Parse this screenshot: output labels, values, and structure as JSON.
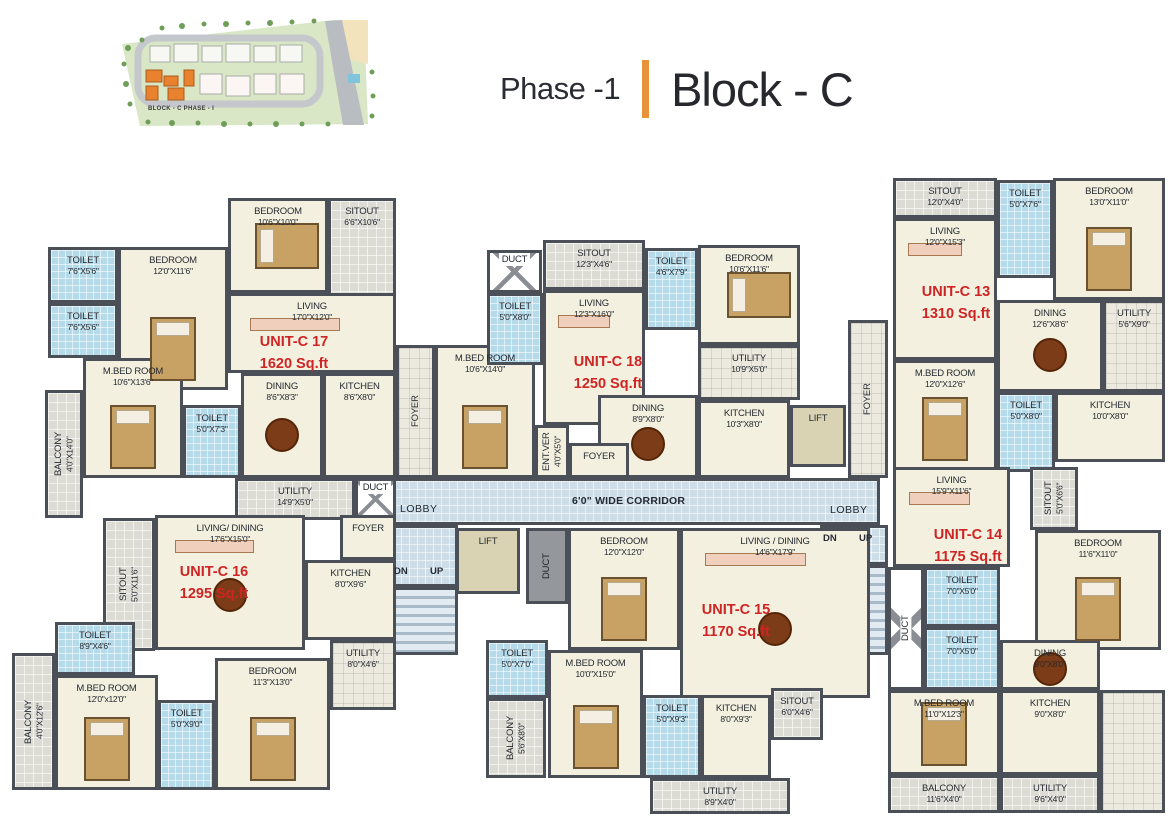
{
  "header": {
    "phase": "Phase -1",
    "block": "Block - C"
  },
  "site_map": {
    "label": "BLOCK - C  PHASE - I"
  },
  "palette": {
    "accent_orange": "#e8923a",
    "wall": "#4b4f58",
    "unit_label_red": "#cf2424",
    "floor_cream": "#f3f0df",
    "toilet_tile_blue": "#b5dbeb",
    "corridor_blue": "#cddee9",
    "sitout_gray": "#dddcd4",
    "lift_olive": "#d9d3b4",
    "site_block_highlight": "#e8822f"
  },
  "plan": {
    "rooms": [
      {
        "u": "common",
        "k": "corridor",
        "n": "",
        "x": 390,
        "y": 478,
        "w": 490,
        "h": 47,
        "f": "corridor"
      },
      {
        "u": "common",
        "k": "lobby-left",
        "n": "",
        "x": 390,
        "y": 525,
        "w": 68,
        "h": 62,
        "f": "corridor"
      },
      {
        "u": "common",
        "k": "lobby-right",
        "n": "",
        "x": 820,
        "y": 525,
        "w": 68,
        "h": 40,
        "f": "corridor"
      },
      {
        "u": "common",
        "k": "stairs-left",
        "n": "",
        "x": 390,
        "y": 587,
        "w": 68,
        "h": 68,
        "f": "stairs"
      },
      {
        "u": "common",
        "k": "stairs-right",
        "n": "",
        "x": 820,
        "y": 565,
        "w": 68,
        "h": 90,
        "f": "stairs"
      },
      {
        "u": "common",
        "n": "FOYER",
        "x": 396,
        "y": 345,
        "w": 39,
        "h": 133,
        "f": "grayx",
        "v": 1
      },
      {
        "u": "common",
        "n": "FOYER",
        "x": 848,
        "y": 320,
        "w": 40,
        "h": 158,
        "f": "grayx",
        "v": 1
      },
      {
        "u": "common",
        "n": "LIFT",
        "x": 790,
        "y": 405,
        "w": 56,
        "h": 62,
        "f": "lift"
      },
      {
        "u": "common",
        "n": "LIFT",
        "x": 456,
        "y": 528,
        "w": 64,
        "h": 66,
        "f": "lift"
      },
      {
        "u": "common",
        "n": "DUCT",
        "x": 526,
        "y": 528,
        "w": 42,
        "h": 76,
        "f": "duct",
        "v": 1
      },
      {
        "u": "17",
        "n": "TOILET",
        "d": "7'6\"X5'6\"",
        "x": 48,
        "y": 247,
        "w": 70,
        "h": 56,
        "f": "tile"
      },
      {
        "u": "17",
        "n": "TOILET",
        "d": "7'6\"X5'6\"",
        "x": 48,
        "y": 303,
        "w": 70,
        "h": 55,
        "f": "tile"
      },
      {
        "u": "17",
        "n": "BEDROOM",
        "d": "12'0\"X11'6\"",
        "x": 118,
        "y": 247,
        "w": 110,
        "h": 143,
        "f": "floor",
        "furn": "bedv"
      },
      {
        "u": "17",
        "n": "BEDROOM",
        "d": "10'6\"X10'0\"",
        "x": 228,
        "y": 198,
        "w": 100,
        "h": 95,
        "f": "floor",
        "furn": "bedh"
      },
      {
        "u": "17",
        "n": "SITOUT",
        "d": "6'6\"X10'6\"",
        "x": 328,
        "y": 198,
        "w": 68,
        "h": 105,
        "f": "gray"
      },
      {
        "u": "17",
        "n": "LIVING",
        "d": "17'0\"X12'0\"",
        "x": 228,
        "y": 293,
        "w": 168,
        "h": 80,
        "f": "floor",
        "furn": "sofa"
      },
      {
        "u": "17",
        "n": "M.BED ROOM",
        "d": "10'6\"X13'6\"",
        "x": 83,
        "y": 358,
        "w": 100,
        "h": 120,
        "f": "floor",
        "furn": "bedv"
      },
      {
        "u": "17",
        "n": "BALCONY",
        "d": "4'0\"X14'0\"",
        "x": 45,
        "y": 390,
        "w": 38,
        "h": 128,
        "f": "gray",
        "v": 1
      },
      {
        "u": "17",
        "n": "TOILET",
        "d": "5'0\"X7'3\"",
        "x": 183,
        "y": 405,
        "w": 58,
        "h": 73,
        "f": "tile"
      },
      {
        "u": "17",
        "n": "DINING",
        "d": "8'6\"X8'3\"",
        "x": 241,
        "y": 373,
        "w": 82,
        "h": 105,
        "f": "floor",
        "furn": "table"
      },
      {
        "u": "17",
        "n": "KITCHEN",
        "d": "8'6\"X8'0\"",
        "x": 323,
        "y": 373,
        "w": 73,
        "h": 105,
        "f": "floor"
      },
      {
        "u": "17",
        "n": "UTILITY",
        "d": "14'9\"X5'0\"",
        "x": 235,
        "y": 478,
        "w": 120,
        "h": 42,
        "f": "gray"
      },
      {
        "u": "17",
        "n": "DUCT",
        "d": "",
        "x": 355,
        "y": 478,
        "w": 41,
        "h": 42,
        "f": "ductx"
      },
      {
        "u": "18",
        "n": "M.BED ROOM",
        "d": "10'6\"X14'0\"",
        "x": 435,
        "y": 345,
        "w": 100,
        "h": 133,
        "f": "floor",
        "furn": "bedv"
      },
      {
        "u": "18",
        "n": "DUCT",
        "d": "",
        "x": 487,
        "y": 250,
        "w": 55,
        "h": 43,
        "f": "ductx"
      },
      {
        "u": "18",
        "n": "TOILET",
        "d": "5'0\"X8'0\"",
        "x": 487,
        "y": 293,
        "w": 56,
        "h": 72,
        "f": "tile"
      },
      {
        "u": "18",
        "n": "SITOUT",
        "d": "12'3\"X4'6\"",
        "x": 543,
        "y": 240,
        "w": 102,
        "h": 50,
        "f": "gray"
      },
      {
        "u": "18",
        "n": "TOILET",
        "d": "4'6\"X7'9\"",
        "x": 645,
        "y": 248,
        "w": 53,
        "h": 82,
        "f": "tile"
      },
      {
        "u": "18",
        "n": "BEDROOM",
        "d": "10'6\"X11'6\"",
        "x": 698,
        "y": 245,
        "w": 102,
        "h": 100,
        "f": "floor",
        "furn": "bedh"
      },
      {
        "u": "18",
        "n": "LIVING",
        "d": "12'3\"X16'0\"",
        "x": 543,
        "y": 290,
        "w": 102,
        "h": 135,
        "f": "floor",
        "furn": "sofa"
      },
      {
        "u": "18",
        "n": "UTILITY",
        "d": "10'9\"X5'0\"",
        "x": 698,
        "y": 345,
        "w": 102,
        "h": 55,
        "f": "grayx"
      },
      {
        "u": "18",
        "n": "DINING",
        "d": "8'9\"X8'0\"",
        "x": 598,
        "y": 395,
        "w": 100,
        "h": 83,
        "f": "floor",
        "furn": "table"
      },
      {
        "u": "18",
        "n": "KITCHEN",
        "d": "10'3\"X8'0\"",
        "x": 698,
        "y": 400,
        "w": 92,
        "h": 78,
        "f": "floor"
      },
      {
        "u": "18",
        "n": "ENT.VER",
        "d": "4'0\"X5'0\"",
        "x": 535,
        "y": 425,
        "w": 34,
        "h": 53,
        "f": "floor",
        "v": 1
      },
      {
        "u": "18",
        "n": "FOYER",
        "d": "",
        "x": 569,
        "y": 443,
        "w": 60,
        "h": 35,
        "f": "floor"
      },
      {
        "u": "13",
        "n": "SITOUT",
        "d": "12'0\"X4'0\"",
        "x": 893,
        "y": 178,
        "w": 104,
        "h": 40,
        "f": "gray"
      },
      {
        "u": "13",
        "n": "TOILET",
        "d": "5'0\"X7'6\"",
        "x": 997,
        "y": 180,
        "w": 56,
        "h": 98,
        "f": "tile"
      },
      {
        "u": "13",
        "n": "BEDROOM",
        "d": "13'0\"X11'0\"",
        "x": 1053,
        "y": 178,
        "w": 112,
        "h": 122,
        "f": "floor",
        "furn": "bedv"
      },
      {
        "u": "13",
        "n": "LIVING",
        "d": "12'0\"X15'3\"",
        "x": 893,
        "y": 218,
        "w": 104,
        "h": 142,
        "f": "floor",
        "furn": "sofa"
      },
      {
        "u": "13",
        "n": "UTILITY",
        "d": "5'6\"X9'0\"",
        "x": 1103,
        "y": 300,
        "w": 62,
        "h": 92,
        "f": "grayx"
      },
      {
        "u": "13",
        "n": "DINING",
        "d": "12'6\"X8'6\"",
        "x": 997,
        "y": 300,
        "w": 106,
        "h": 92,
        "f": "floor",
        "furn": "table"
      },
      {
        "u": "13",
        "n": "M.BED ROOM",
        "d": "12'0\"X12'6\"",
        "x": 893,
        "y": 360,
        "w": 104,
        "h": 110,
        "f": "floor",
        "furn": "bedv"
      },
      {
        "u": "13",
        "n": "TOILET",
        "d": "5'0\"X8'0\"",
        "x": 997,
        "y": 392,
        "w": 58,
        "h": 80,
        "f": "tile"
      },
      {
        "u": "13",
        "n": "KITCHEN",
        "d": "10'0\"X8'0\"",
        "x": 1055,
        "y": 392,
        "w": 110,
        "h": 70,
        "f": "floor"
      },
      {
        "u": "14",
        "n": "LIVING",
        "d": "15'9\"X11'6\"",
        "x": 893,
        "y": 467,
        "w": 117,
        "h": 100,
        "f": "floor",
        "furn": "sofa"
      },
      {
        "u": "14",
        "n": "SITOUT",
        "d": "5'0\"X6'6\"",
        "x": 1030,
        "y": 467,
        "w": 48,
        "h": 63,
        "f": "gray",
        "v": 1
      },
      {
        "u": "14",
        "n": "BEDROOM",
        "d": "11'6\"X11'0\"",
        "x": 1035,
        "y": 530,
        "w": 126,
        "h": 120,
        "f": "floor",
        "furn": "bedv"
      },
      {
        "u": "14",
        "n": "DUCT",
        "d": "",
        "x": 888,
        "y": 567,
        "w": 36,
        "h": 123,
        "f": "ductx",
        "v": 1
      },
      {
        "u": "14",
        "n": "TOILET",
        "d": "7'0\"X5'0\"",
        "x": 924,
        "y": 567,
        "w": 76,
        "h": 60,
        "f": "tile"
      },
      {
        "u": "14",
        "n": "TOILET",
        "d": "7'0\"X5'0\"",
        "x": 924,
        "y": 627,
        "w": 76,
        "h": 63,
        "f": "tile"
      },
      {
        "u": "14",
        "n": "DINING",
        "d": "9'0\"X8'0\"",
        "x": 1000,
        "y": 640,
        "w": 100,
        "h": 50,
        "f": "floor",
        "furn": "table"
      },
      {
        "u": "14",
        "n": "M.BED ROOM",
        "d": "11'0\"X12'3\"",
        "x": 888,
        "y": 690,
        "w": 112,
        "h": 85,
        "f": "floor",
        "furn": "bedv"
      },
      {
        "u": "14",
        "n": "KITCHEN",
        "d": "9'0\"X8'0\"",
        "x": 1000,
        "y": 690,
        "w": 100,
        "h": 85,
        "f": "floor"
      },
      {
        "u": "14",
        "n": "",
        "k": "terrace",
        "x": 1100,
        "y": 690,
        "w": 65,
        "h": 123,
        "f": "grayx"
      },
      {
        "u": "14",
        "n": "BALCONY",
        "d": "11'6\"X4'0\"",
        "x": 888,
        "y": 775,
        "w": 112,
        "h": 38,
        "f": "gray"
      },
      {
        "u": "14",
        "n": "UTILITY",
        "d": "9'6\"X4'0\"",
        "x": 1000,
        "y": 775,
        "w": 100,
        "h": 38,
        "f": "gray"
      },
      {
        "u": "15",
        "n": "BEDROOM",
        "d": "12'0\"X12'0\"",
        "x": 568,
        "y": 528,
        "w": 112,
        "h": 122,
        "f": "floor",
        "furn": "bedv"
      },
      {
        "u": "15",
        "n": "LIVING / DINING",
        "d": "14'6\"X17'9\"",
        "x": 680,
        "y": 528,
        "w": 190,
        "h": 170,
        "f": "floor",
        "furn": "sofa table"
      },
      {
        "u": "15",
        "n": "TOILET",
        "d": "5'0\"X7'0\"",
        "x": 486,
        "y": 640,
        "w": 62,
        "h": 58,
        "f": "tile"
      },
      {
        "u": "15",
        "n": "M.BED ROOM",
        "d": "10'0\"X15'0\"",
        "x": 548,
        "y": 650,
        "w": 95,
        "h": 128,
        "f": "floor",
        "furn": "bedv"
      },
      {
        "u": "15",
        "n": "BALCONY",
        "d": "5'6\"X8'0\"",
        "x": 486,
        "y": 698,
        "w": 60,
        "h": 80,
        "f": "gray",
        "v": 1
      },
      {
        "u": "15",
        "n": "TOILET",
        "d": "5'0\"X9'3\"",
        "x": 643,
        "y": 695,
        "w": 58,
        "h": 83,
        "f": "tile"
      },
      {
        "u": "15",
        "n": "KITCHEN",
        "d": "8'0\"X9'3\"",
        "x": 701,
        "y": 695,
        "w": 70,
        "h": 83,
        "f": "floor"
      },
      {
        "u": "15",
        "n": "SITOUT",
        "d": "6'0\"X4'6\"",
        "x": 771,
        "y": 688,
        "w": 52,
        "h": 52,
        "f": "gray"
      },
      {
        "u": "15",
        "n": "UTILITY",
        "d": "8'9\"X4'0\"",
        "x": 650,
        "y": 778,
        "w": 140,
        "h": 36,
        "f": "gray"
      },
      {
        "u": "16",
        "n": "SITOUT",
        "d": "5'0\"X11'6\"",
        "x": 103,
        "y": 518,
        "w": 52,
        "h": 133,
        "f": "gray",
        "v": 1
      },
      {
        "u": "16",
        "n": "LIVING/ DINING",
        "d": "17'6\"X15'0\"",
        "x": 155,
        "y": 515,
        "w": 150,
        "h": 135,
        "f": "floor",
        "furn": "sofa table"
      },
      {
        "u": "16",
        "n": "FOYER",
        "d": "",
        "x": 340,
        "y": 515,
        "w": 56,
        "h": 45,
        "f": "floor"
      },
      {
        "u": "16",
        "n": "KITCHEN",
        "d": "8'0\"X9'6\"",
        "x": 305,
        "y": 560,
        "w": 91,
        "h": 80,
        "f": "floor"
      },
      {
        "u": "16",
        "n": "TOILET",
        "d": "8'9\"X4'6\"",
        "x": 55,
        "y": 622,
        "w": 80,
        "h": 53,
        "f": "tile"
      },
      {
        "u": "16",
        "n": "M.BED ROOM",
        "d": "12'0\"x12'0\"",
        "x": 55,
        "y": 675,
        "w": 103,
        "h": 115,
        "f": "floor",
        "furn": "bedv"
      },
      {
        "u": "16",
        "n": "BALCONY",
        "d": "4'0\"X12'6\"",
        "x": 12,
        "y": 653,
        "w": 43,
        "h": 137,
        "f": "gray",
        "v": 1
      },
      {
        "u": "16",
        "n": "TOILET",
        "d": "5'0\"X9'0\"",
        "x": 158,
        "y": 700,
        "w": 57,
        "h": 90,
        "f": "tile"
      },
      {
        "u": "16",
        "n": "BEDROOM",
        "d": "11'3\"X13'0\"",
        "x": 215,
        "y": 658,
        "w": 115,
        "h": 132,
        "f": "floor",
        "furn": "bedv"
      },
      {
        "u": "16",
        "n": "UTILITY",
        "d": "8'0\"X4'6\"",
        "x": 330,
        "y": 640,
        "w": 66,
        "h": 70,
        "f": "grayx"
      }
    ],
    "unit_labels": [
      {
        "id": "17",
        "title": "UNIT-C 17",
        "area": "1620 Sq.ft",
        "x": 238,
        "y": 332
      },
      {
        "id": "18",
        "title": "UNIT-C 18",
        "area": "1250 Sq.ft",
        "x": 552,
        "y": 352
      },
      {
        "id": "13",
        "title": "UNIT-C 13",
        "area": "1310 Sq.ft",
        "x": 900,
        "y": 282
      },
      {
        "id": "14",
        "title": "UNIT-C 14",
        "area": "1175 Sq.ft",
        "x": 912,
        "y": 525
      },
      {
        "id": "15",
        "title": "UNIT-C 15",
        "area": "1170 Sq.ft",
        "x": 680,
        "y": 600
      },
      {
        "id": "16",
        "title": "UNIT-C 16",
        "area": "1295 Sq.ft",
        "x": 158,
        "y": 562
      }
    ],
    "text_labels": [
      {
        "t": "6'0\" WIDE CORRIDOR",
        "x": 572,
        "y": 495,
        "c": "corr"
      },
      {
        "t": "LOBBY",
        "x": 400,
        "y": 503,
        "c": "lobby"
      },
      {
        "t": "LOBBY",
        "x": 830,
        "y": 504,
        "c": "lobby"
      },
      {
        "t": "DN",
        "x": 394,
        "y": 566,
        "c": "dnup"
      },
      {
        "t": "UP",
        "x": 430,
        "y": 566,
        "c": "dnup"
      },
      {
        "t": "DN",
        "x": 823,
        "y": 533,
        "c": "dnup"
      },
      {
        "t": "UP",
        "x": 859,
        "y": 533,
        "c": "dnup"
      }
    ]
  }
}
